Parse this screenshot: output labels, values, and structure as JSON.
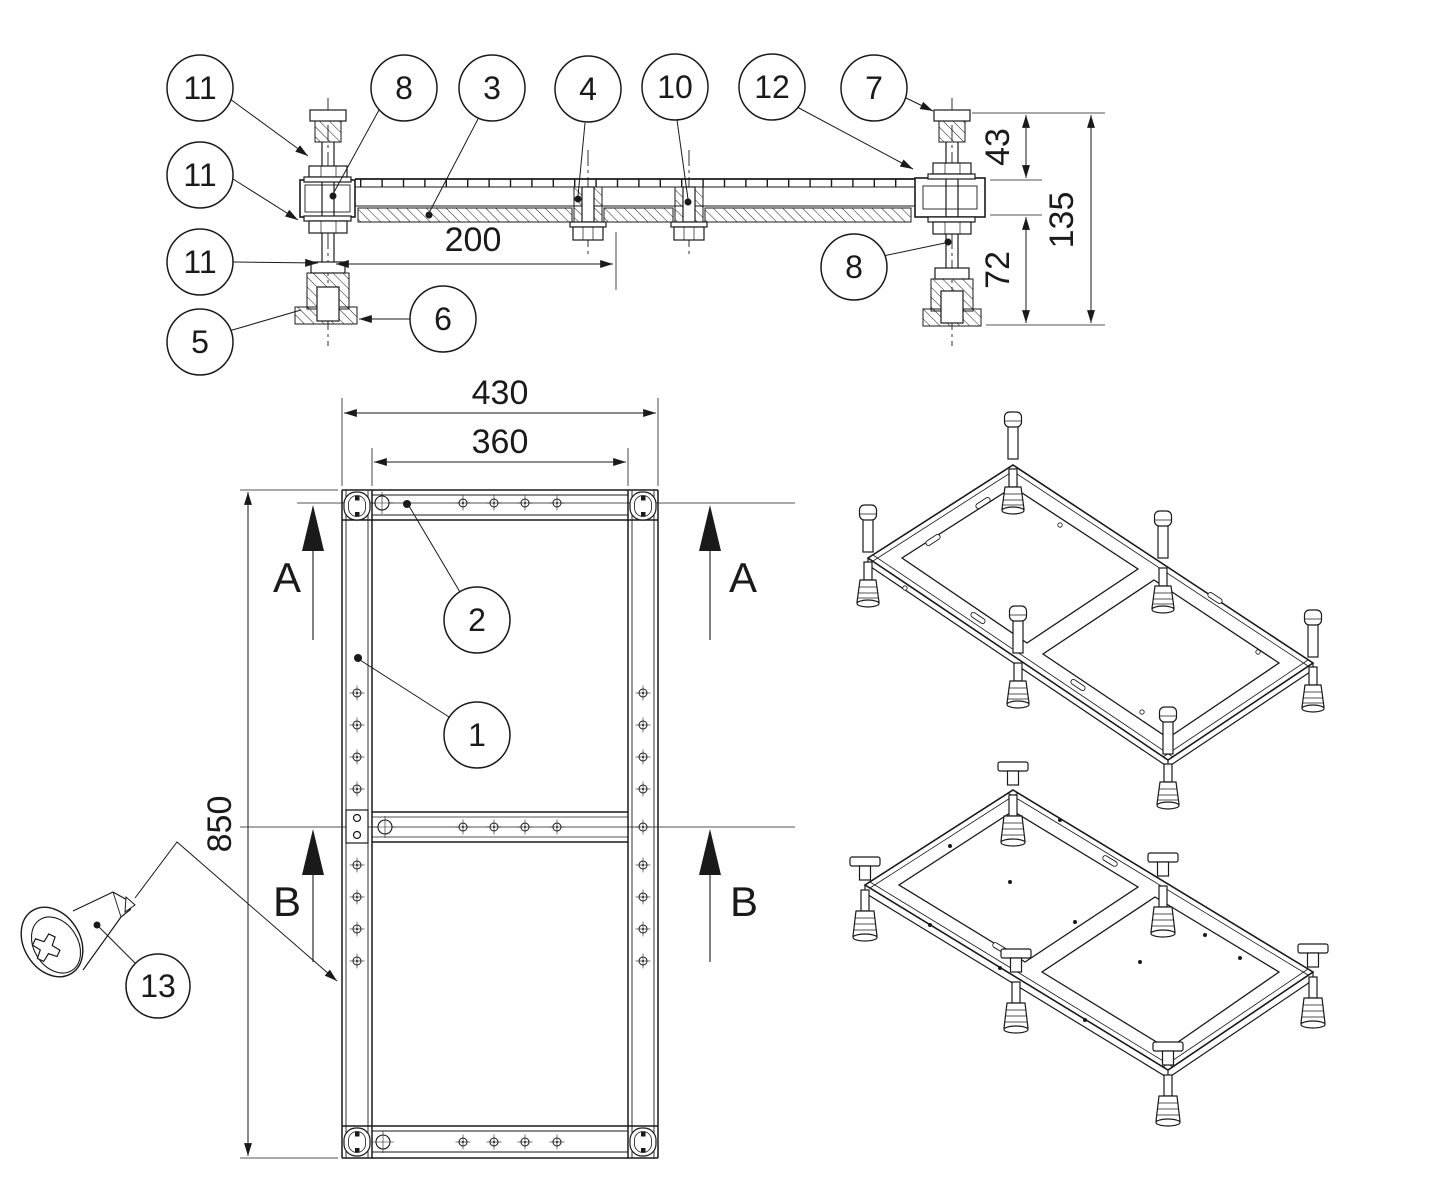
{
  "balloons": {
    "n11a": "11",
    "n11b": "11",
    "n11c": "11",
    "n5": "5",
    "n8a": "8",
    "n3": "3",
    "n4": "4",
    "n10": "10",
    "n12": "12",
    "n7": "7",
    "n8b": "8",
    "n6": "6",
    "n2": "2",
    "n1": "1",
    "n13": "13"
  },
  "dimensions": {
    "d200": "200",
    "d43": "43",
    "d135": "135",
    "d72": "72",
    "d430": "430",
    "d360": "360",
    "d850": "850"
  },
  "section_markers": {
    "a_left": "A",
    "a_right": "A",
    "b_left": "B",
    "b_right": "B"
  }
}
